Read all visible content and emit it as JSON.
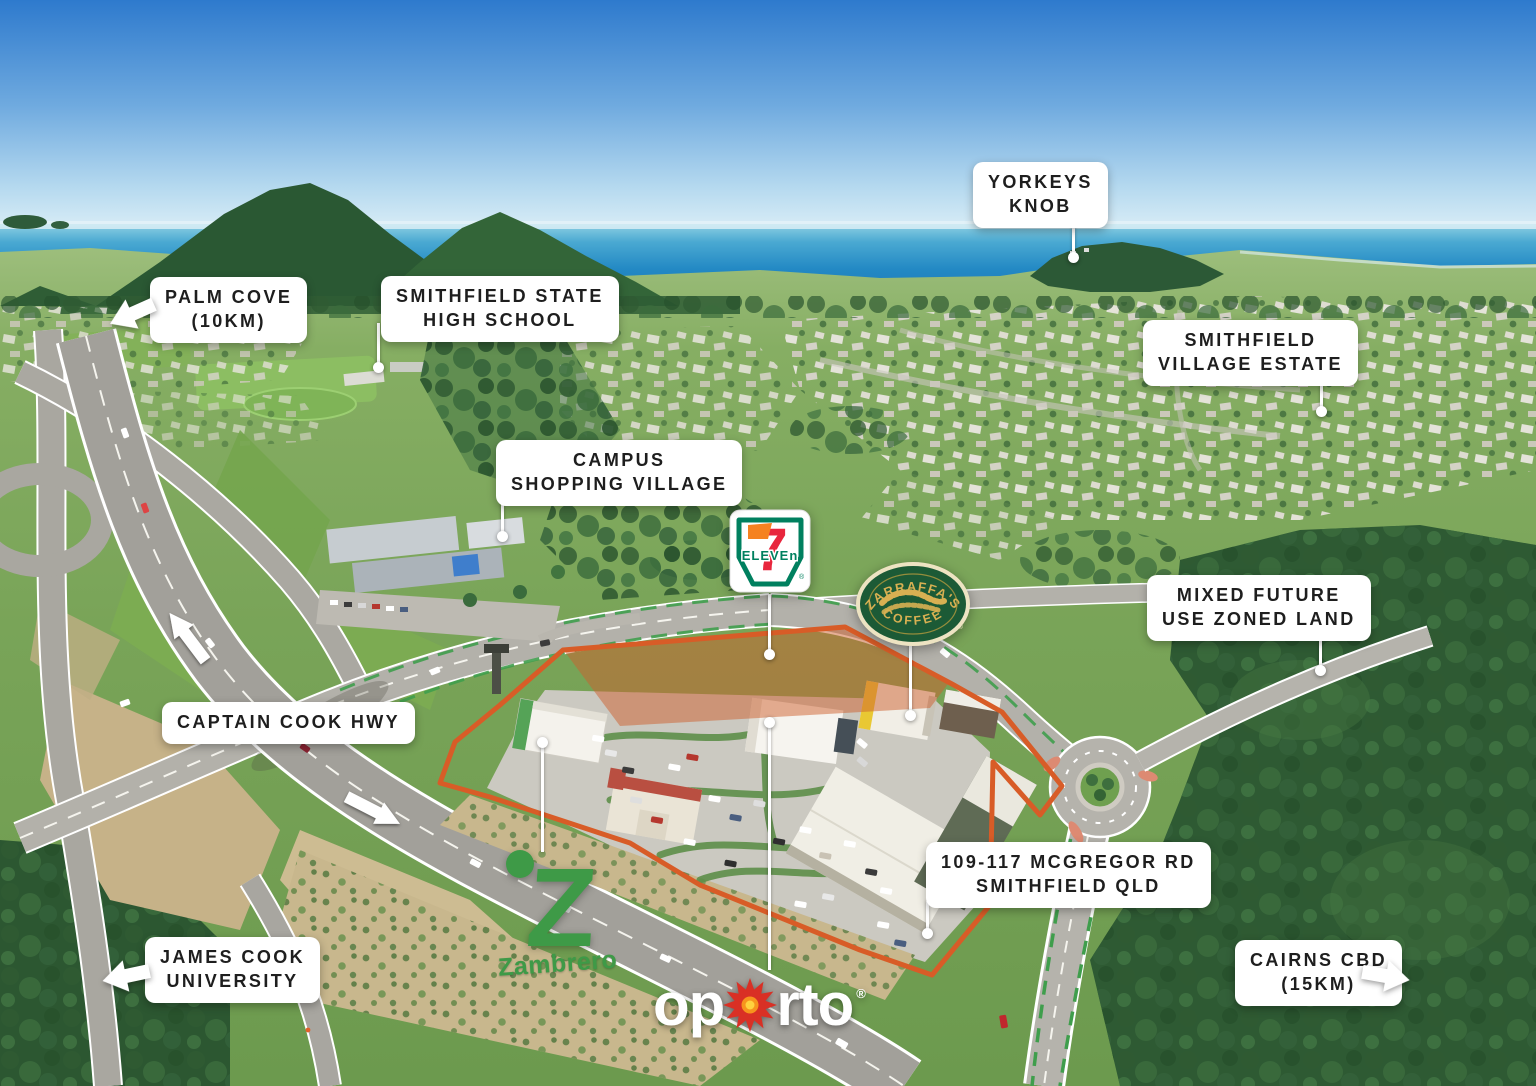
{
  "labels": {
    "palm_cove": {
      "line1": "PALM COVE",
      "line2": "(10KM)"
    },
    "smithfield_high": {
      "line1": "SMITHFIELD STATE",
      "line2": "HIGH SCHOOL"
    },
    "yorkeys_knob": {
      "line1": "YORKEYS",
      "line2": "KNOB"
    },
    "village_estate": {
      "line1": "SMITHFIELD",
      "line2": "VILLAGE ESTATE"
    },
    "campus_village": {
      "line1": "CAMPUS",
      "line2": "SHOPPING VILLAGE"
    },
    "mixed_use": {
      "line1": "MIXED FUTURE",
      "line2": "USE ZONED LAND"
    },
    "captain_cook_hwy": {
      "line1": "CAPTAIN COOK HWY"
    },
    "mcgregor_address": {
      "line1": "109-117 MCGREGOR RD",
      "line2": "SMITHFIELD QLD"
    },
    "james_cook_uni": {
      "line1": "JAMES COOK",
      "line2": "UNIVERSITY"
    },
    "cairns_cbd": {
      "line1": "CAIRNS CBD",
      "line2": "(15KM)"
    }
  },
  "logos": {
    "seven_eleven": {
      "numeral": "7",
      "word": "ELEVEn",
      "registered": "®"
    },
    "zarraffas": {
      "top": "ZARRAFFA'S",
      "bottom": "COFFEE",
      "registered": "®"
    },
    "zambrero": {
      "initial": "Z",
      "wordmark": "Zambrero"
    },
    "oporto": {
      "left": "op",
      "right": "rto",
      "registered": "®"
    }
  },
  "colors": {
    "site_boundary": "#D85C27",
    "site_highlight_fill": "rgba(205,95,45,0.5)",
    "label_background": "#FFFFFF",
    "label_text": "#1E1E1E",
    "seven_eleven_green": "#00805F",
    "seven_eleven_orange": "#F58220",
    "seven_eleven_red": "#E8263D",
    "zarraffas_green": "#1C5A36",
    "zarraffas_gold": "#D8B052",
    "zambrero_green": "#3E9A47",
    "oporto_red": "#D93025",
    "oporto_orange": "#F7941D"
  }
}
